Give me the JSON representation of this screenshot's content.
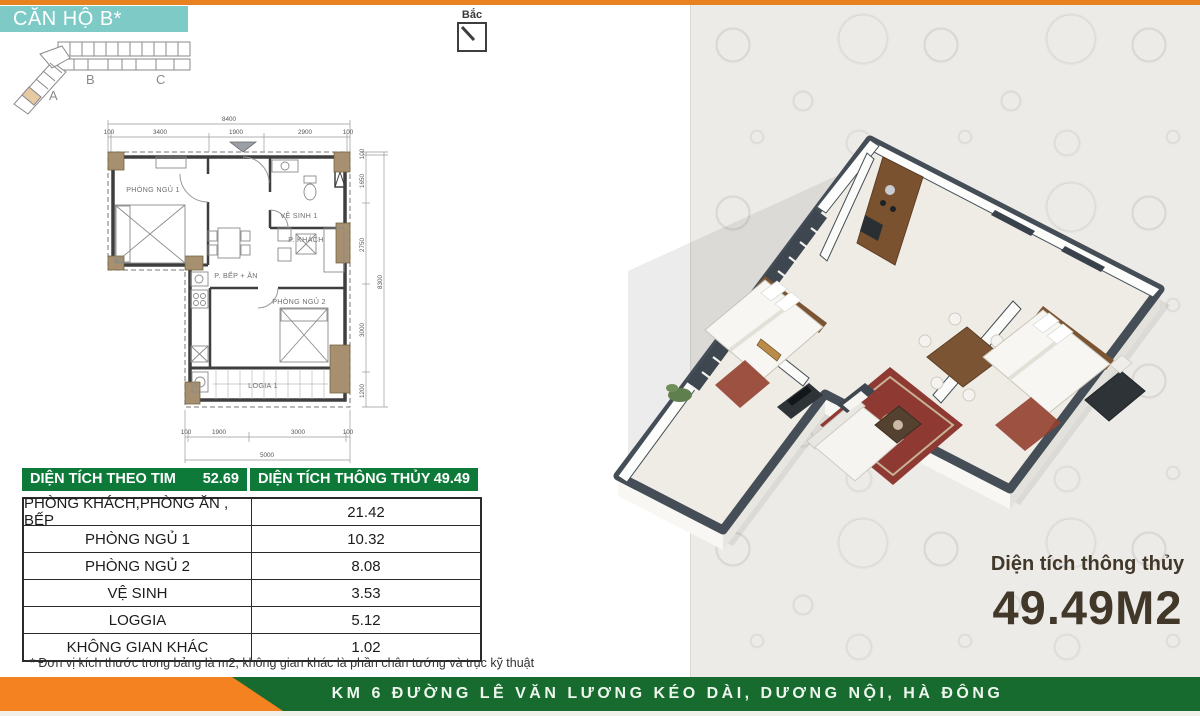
{
  "header": {
    "unit_title": "CĂN HỘ B*",
    "compass_label": "Bắc"
  },
  "key_plan": {
    "labels": [
      "A",
      "B",
      "C"
    ]
  },
  "floor_plan": {
    "rooms": [
      "PHÒNG NGỦ 1",
      "VỆ SINH 1",
      "P. KHÁCH",
      "P. BẾP + ĂN",
      "PHÒNG NGỦ 2",
      "LOGIA 1"
    ],
    "dims": {
      "top_total": "8400",
      "top": [
        "100",
        "3400",
        "1900",
        "2900",
        "100"
      ],
      "right": [
        "100",
        "1650",
        "2750",
        "3000",
        "1200"
      ],
      "right_total": "8300",
      "bottom": [
        "100",
        "1900",
        "3000",
        "100"
      ],
      "bottom_total": "5000"
    }
  },
  "area_table": {
    "header_left": {
      "label": "DIỆN TÍCH THEO TIM",
      "value": "52.69"
    },
    "header_right": {
      "label": "DIỆN TÍCH THÔNG THỦY",
      "value": "49.49"
    },
    "rows": [
      {
        "label": "PHÒNG KHÁCH,PHÒNG ĂN , BẾP",
        "value": "21.42"
      },
      {
        "label": "PHÒNG NGỦ 1",
        "value": "10.32"
      },
      {
        "label": "PHÒNG NGỦ 2",
        "value": "8.08"
      },
      {
        "label": "VỆ SINH",
        "value": "3.53"
      },
      {
        "label": "LOGGIA",
        "value": "5.12"
      },
      {
        "label": "KHÔNG GIAN KHÁC",
        "value": "1.02"
      }
    ],
    "footnote": "* Đơn vị kích thước trong bảng là m2, không gian khác là phần chân tướng và trục kỹ thuật"
  },
  "right_panel": {
    "area_label": "Diện tích thông thủy",
    "area_value": "49.49M2"
  },
  "footer": {
    "address": "KM 6 ĐƯỜNG LÊ VĂN LƯƠNG KÉO DÀI, DƯƠNG NỘI, HÀ ĐÔNG"
  },
  "colors": {
    "accent_orange": "#E8811F",
    "arrow_orange": "#F58220",
    "teal": "#7DCAC7",
    "table_green": "#0E7A39",
    "footer_green": "#186B2F",
    "area_text": "#42382A",
    "panel_bg": "#ECEBE8"
  }
}
